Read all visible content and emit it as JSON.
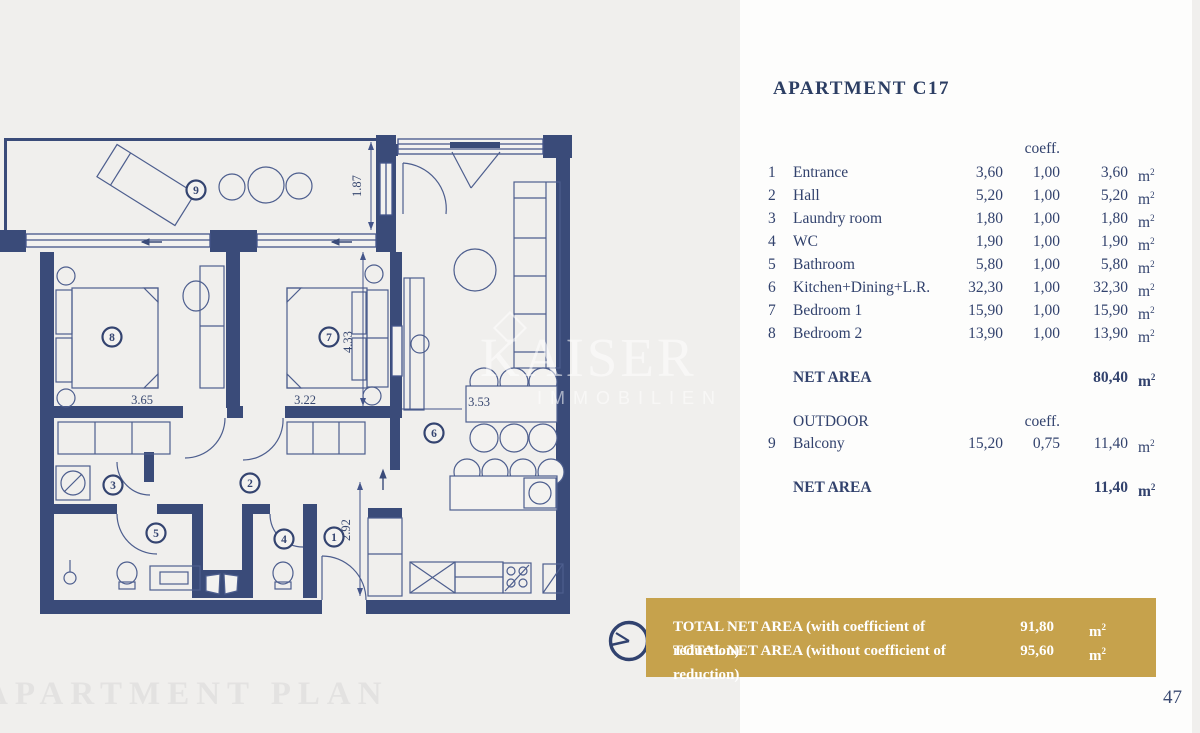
{
  "page": {
    "footer_title": "APARTMENT PLAN",
    "page_number": "47",
    "colors": {
      "page_bg": "#f0efed",
      "panel_bg": "#fdfdfc",
      "wall_navy": "#3a4b79",
      "text_navy": "#32426d",
      "gold": "#c6a24c",
      "footer_gray": "#e3e2e1"
    }
  },
  "panel": {
    "title": "APARTMENT C17",
    "coeff_header": "coeff.",
    "unit_base": "m",
    "unit_sup": "2",
    "rooms": [
      {
        "num": "1",
        "name": "Entrance",
        "area": "3,60",
        "coeff": "1,00",
        "result": "3,60"
      },
      {
        "num": "2",
        "name": "Hall",
        "area": "5,20",
        "coeff": "1,00",
        "result": "5,20"
      },
      {
        "num": "3",
        "name": "Laundry room",
        "area": "1,80",
        "coeff": "1,00",
        "result": "1,80"
      },
      {
        "num": "4",
        "name": "WC",
        "area": "1,90",
        "coeff": "1,00",
        "result": "1,90"
      },
      {
        "num": "5",
        "name": "Bathroom",
        "area": "5,80",
        "coeff": "1,00",
        "result": "5,80"
      },
      {
        "num": "6",
        "name": "Kitchen+Dining+L.R.",
        "area": "32,30",
        "coeff": "1,00",
        "result": "32,30"
      },
      {
        "num": "7",
        "name": "Bedroom 1",
        "area": "15,90",
        "coeff": "1,00",
        "result": "15,90"
      },
      {
        "num": "8",
        "name": "Bedroom 2",
        "area": "13,90",
        "coeff": "1,00",
        "result": "13,90"
      }
    ],
    "net_area": {
      "label": "NET AREA",
      "value": "80,40"
    },
    "outdoor": {
      "label": "OUTDOOR",
      "coeff_header": "coeff.",
      "rows": [
        {
          "num": "9",
          "name": "Balcony",
          "area": "15,20",
          "coeff": "0,75",
          "result": "11,40"
        }
      ],
      "net_label": "NET AREA",
      "net_value": "11,40"
    }
  },
  "banner": {
    "rows": [
      {
        "label": "TOTAL NET AREA (with coefficient of reduction)",
        "value": "91,80"
      },
      {
        "label": "TOTAL NET AREA (without coefficient of reduction)",
        "value": "95,60"
      }
    ]
  },
  "plan": {
    "room_numbers": [
      "1",
      "2",
      "3",
      "4",
      "5",
      "6",
      "7",
      "8",
      "9"
    ],
    "dims": {
      "balcony_depth": "1.87",
      "bedroom2_width": "3.65",
      "bedroom1_width": "3.22",
      "bedroom1_depth": "4.33",
      "dining_width": "3.53",
      "entrance_depth": "2.92"
    },
    "watermark": {
      "name": "KAISER",
      "subtitle": "IMMOBILIEN"
    }
  }
}
